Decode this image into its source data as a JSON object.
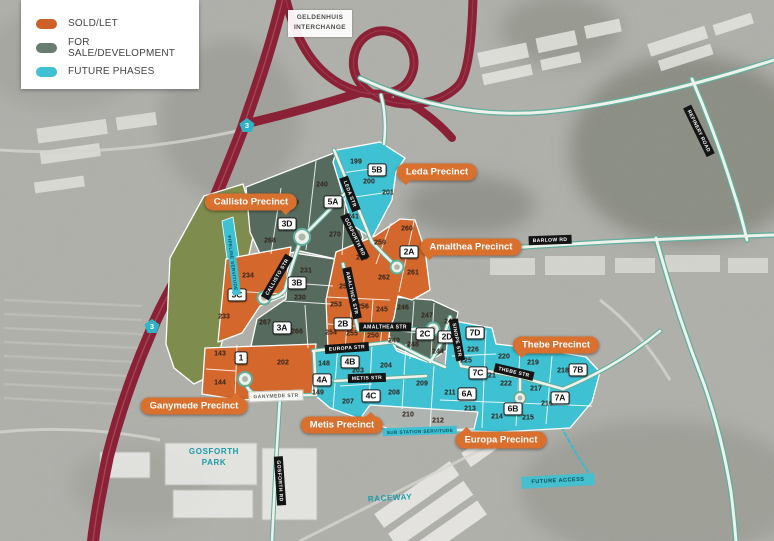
{
  "colors": {
    "sold": "#ce5f27",
    "for_sale": "#697c70",
    "future_phases": "#3ec1d3",
    "map_orange": "#d4682c",
    "map_sage": "#566b5e",
    "map_cyan": "#3ec1d3",
    "olive_open_space": "#7e8d4e",
    "highway_red": "#8a2136",
    "road_teal": "#5fae9e",
    "callout_orange": "#d9702e"
  },
  "legend": {
    "items": [
      {
        "label": "SOLD/LET"
      },
      {
        "label": "FOR SALE/DEVELOPMENT"
      },
      {
        "label": "FUTURE PHASES"
      }
    ]
  },
  "interchange_label": {
    "line1": "GELDENHUIS",
    "line2": "INTERCHANGE"
  },
  "route_shields": [
    {
      "number": "3",
      "x": 247,
      "y": 125
    },
    {
      "number": "3",
      "x": 152,
      "y": 326
    }
  ],
  "area_labels": [
    {
      "text": "GOSFORTH\nPARK",
      "x": 214,
      "y": 457,
      "style": "teal-text",
      "rotate": 0
    },
    {
      "text": "RACEWAY",
      "x": 390,
      "y": 498,
      "style": "teal-text",
      "rotate": -3
    },
    {
      "text": "FUTURE ACCESS",
      "x": 558,
      "y": 481,
      "style": "cyan-box",
      "rotate": -3
    }
  ],
  "precinct_callouts": [
    {
      "label": "Leda Precinct",
      "x": 437,
      "y": 172,
      "tail": "bl"
    },
    {
      "label": "Callisto Precinct",
      "x": 251,
      "y": 202,
      "tail": "br"
    },
    {
      "label": "Amalthea Precinct",
      "x": 471,
      "y": 247,
      "tail": "bl"
    },
    {
      "label": "Thebe Precinct",
      "x": 556,
      "y": 345,
      "tail": "bl"
    },
    {
      "label": "Ganymede Precinct",
      "x": 194,
      "y": 406,
      "tail": "tr"
    },
    {
      "label": "Metis Precinct",
      "x": 342,
      "y": 425,
      "tail": "tr"
    },
    {
      "label": "Europa Precinct",
      "x": 501,
      "y": 440,
      "tail": "tl"
    }
  ],
  "badges": [
    {
      "t": "5B",
      "x": 377,
      "y": 170
    },
    {
      "t": "5A",
      "x": 333,
      "y": 202
    },
    {
      "t": "3D",
      "x": 287,
      "y": 224
    },
    {
      "t": "2A",
      "x": 409,
      "y": 252
    },
    {
      "t": "3B",
      "x": 297,
      "y": 283
    },
    {
      "t": "3C",
      "x": 237,
      "y": 295
    },
    {
      "t": "3A",
      "x": 282,
      "y": 328
    },
    {
      "t": "2B",
      "x": 343,
      "y": 324
    },
    {
      "t": "2C",
      "x": 425,
      "y": 334
    },
    {
      "t": "2D",
      "x": 447,
      "y": 337
    },
    {
      "t": "7D",
      "x": 475,
      "y": 333
    },
    {
      "t": "7C",
      "x": 478,
      "y": 373
    },
    {
      "t": "7B",
      "x": 578,
      "y": 370
    },
    {
      "t": "7A",
      "x": 560,
      "y": 398
    },
    {
      "t": "6A",
      "x": 467,
      "y": 394
    },
    {
      "t": "6B",
      "x": 513,
      "y": 409
    },
    {
      "t": "1",
      "x": 241,
      "y": 358
    },
    {
      "t": "4A",
      "x": 322,
      "y": 380
    },
    {
      "t": "4B",
      "x": 350,
      "y": 362
    },
    {
      "t": "4C",
      "x": 371,
      "y": 396
    }
  ],
  "plots": [
    {
      "n": "199",
      "x": 356,
      "y": 162
    },
    {
      "n": "200",
      "x": 369,
      "y": 182
    },
    {
      "n": "201",
      "x": 388,
      "y": 193
    },
    {
      "n": "240",
      "x": 322,
      "y": 185
    },
    {
      "n": "241",
      "x": 353,
      "y": 217
    },
    {
      "n": "269",
      "x": 293,
      "y": 203
    },
    {
      "n": "270",
      "x": 335,
      "y": 235
    },
    {
      "n": "268",
      "x": 270,
      "y": 241
    },
    {
      "n": "234",
      "x": 248,
      "y": 276
    },
    {
      "n": "233",
      "x": 224,
      "y": 317
    },
    {
      "n": "231",
      "x": 306,
      "y": 271
    },
    {
      "n": "230",
      "x": 300,
      "y": 298
    },
    {
      "n": "267",
      "x": 265,
      "y": 323
    },
    {
      "n": "266",
      "x": 297,
      "y": 332
    },
    {
      "n": "143",
      "x": 220,
      "y": 354
    },
    {
      "n": "144",
      "x": 220,
      "y": 383
    },
    {
      "n": "202",
      "x": 283,
      "y": 363
    },
    {
      "n": "258",
      "x": 362,
      "y": 258
    },
    {
      "n": "259",
      "x": 380,
      "y": 243
    },
    {
      "n": "260",
      "x": 407,
      "y": 229
    },
    {
      "n": "261",
      "x": 413,
      "y": 273
    },
    {
      "n": "262",
      "x": 384,
      "y": 278
    },
    {
      "n": "252",
      "x": 345,
      "y": 287
    },
    {
      "n": "253",
      "x": 336,
      "y": 305
    },
    {
      "n": "256",
      "x": 363,
      "y": 307
    },
    {
      "n": "245",
      "x": 382,
      "y": 310
    },
    {
      "n": "254",
      "x": 331,
      "y": 333
    },
    {
      "n": "255",
      "x": 352,
      "y": 334
    },
    {
      "n": "250",
      "x": 373,
      "y": 336
    },
    {
      "n": "246",
      "x": 403,
      "y": 308
    },
    {
      "n": "247",
      "x": 427,
      "y": 316
    },
    {
      "n": "249",
      "x": 394,
      "y": 341
    },
    {
      "n": "248",
      "x": 413,
      "y": 345
    },
    {
      "n": "243",
      "x": 450,
      "y": 322
    },
    {
      "n": "244",
      "x": 438,
      "y": 352
    },
    {
      "n": "148",
      "x": 324,
      "y": 364
    },
    {
      "n": "149",
      "x": 318,
      "y": 393
    },
    {
      "n": "207",
      "x": 348,
      "y": 402
    },
    {
      "n": "203",
      "x": 358,
      "y": 371
    },
    {
      "n": "204",
      "x": 386,
      "y": 366
    },
    {
      "n": "208",
      "x": 394,
      "y": 393
    },
    {
      "n": "209",
      "x": 422,
      "y": 384
    },
    {
      "n": "210",
      "x": 408,
      "y": 415
    },
    {
      "n": "212",
      "x": 438,
      "y": 421
    },
    {
      "n": "211",
      "x": 450,
      "y": 393
    },
    {
      "n": "213",
      "x": 470,
      "y": 409
    },
    {
      "n": "214",
      "x": 497,
      "y": 417
    },
    {
      "n": "215",
      "x": 528,
      "y": 418
    },
    {
      "n": "216",
      "x": 547,
      "y": 404
    },
    {
      "n": "217",
      "x": 536,
      "y": 389
    },
    {
      "n": "218",
      "x": 563,
      "y": 371
    },
    {
      "n": "219",
      "x": 533,
      "y": 363
    },
    {
      "n": "220",
      "x": 504,
      "y": 357
    },
    {
      "n": "221",
      "x": 490,
      "y": 376
    },
    {
      "n": "222",
      "x": 506,
      "y": 384
    },
    {
      "n": "225",
      "x": 466,
      "y": 361
    },
    {
      "n": "226",
      "x": 473,
      "y": 350
    }
  ],
  "streets": [
    {
      "name": "LEDA STR",
      "x": 350,
      "y": 194,
      "r": 69,
      "variant": "dark"
    },
    {
      "name": "GOSFORTH RD",
      "x": 355,
      "y": 237,
      "r": 64,
      "variant": "dark"
    },
    {
      "name": "CALLISTO STR",
      "x": 277,
      "y": 277,
      "r": -60,
      "variant": "dark"
    },
    {
      "name": "AMALTHEA STR",
      "x": 352,
      "y": 293,
      "r": 78,
      "variant": "dark"
    },
    {
      "name": "AMALTHEA STR",
      "x": 385,
      "y": 327,
      "r": 0,
      "variant": "dark"
    },
    {
      "name": "EUROPA STR",
      "x": 347,
      "y": 348,
      "r": -4,
      "variant": "dark"
    },
    {
      "name": "METIS STR",
      "x": 367,
      "y": 378,
      "r": -2,
      "variant": "dark"
    },
    {
      "name": "GANYMEDE STR",
      "x": 276,
      "y": 396,
      "r": -2,
      "variant": "light"
    },
    {
      "name": "THEBE STR",
      "x": 514,
      "y": 372,
      "r": 13,
      "variant": "dark"
    },
    {
      "name": "SINOPE STR",
      "x": 457,
      "y": 340,
      "r": 80,
      "variant": "dark"
    },
    {
      "name": "BARLOW RD",
      "x": 550,
      "y": 240,
      "r": -2,
      "variant": "dark"
    },
    {
      "name": "REFINERY ROAD",
      "x": 699,
      "y": 131,
      "r": 64,
      "variant": "dark"
    },
    {
      "name": "GOSFORTH RD",
      "x": 280,
      "y": 481,
      "r": 86,
      "variant": "dark"
    },
    {
      "name": "SUB STATION SERVITUDE",
      "x": 420,
      "y": 431,
      "r": -2,
      "variant": "cyan"
    },
    {
      "name": "PIPELINE SERVITUDE",
      "x": 233,
      "y": 263,
      "r": 83,
      "variant": "cyan"
    }
  ]
}
